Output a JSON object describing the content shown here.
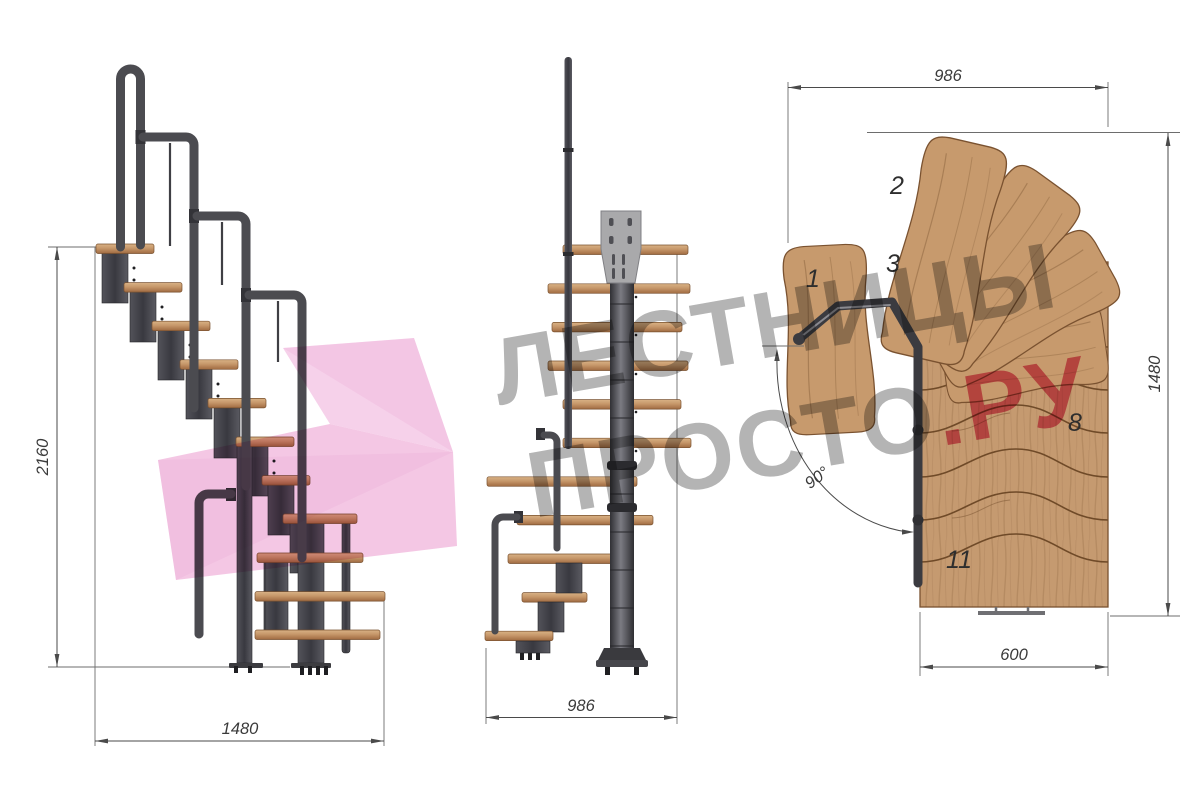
{
  "watermark": {
    "line1": "ЛЕСТНИЦЫ",
    "line2_main": "ПРОСТО",
    "line2_accent": ".РУ"
  },
  "views": {
    "side": {
      "dim_height": "2160",
      "dim_depth": "1480"
    },
    "front": {
      "dim_width": "986"
    },
    "plan": {
      "dim_width": "986",
      "dim_length": "1480",
      "dim_flight_width": "600",
      "dim_angle": "90°",
      "tread_numbers": [
        "1",
        "2",
        "3",
        "8",
        "11"
      ]
    }
  },
  "colors": {
    "wood": "#c79a6d",
    "wood_edge": "#7a5230",
    "metal": "#47474b",
    "metal_dark": "#2f2f33",
    "plate_gray": "#a9a9ab",
    "dim": "#3a3a3a",
    "watermark_gray": "#b4b4b4",
    "watermark_red": "#e5718f",
    "watermark_pink": "#f3c5e4"
  }
}
